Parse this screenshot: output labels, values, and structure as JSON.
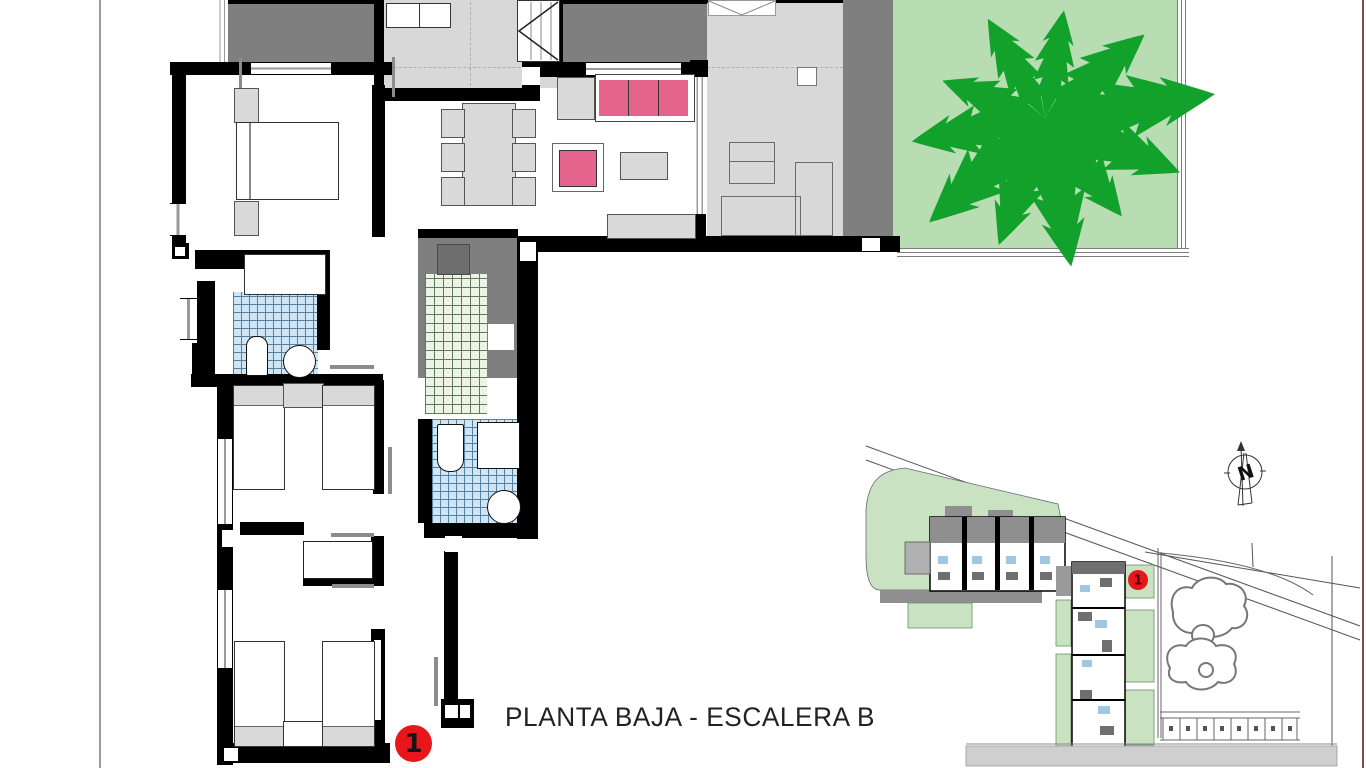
{
  "page": {
    "background": "#ffffff",
    "fold_line_color": "#9b9b9b",
    "edge_line_color": "#8a4a44"
  },
  "plan": {
    "title": "PLANTA BAJA - ESCALERA B",
    "unit_marker": "1",
    "colors": {
      "wall": "#000000",
      "dark_floor": "#7f7f7f",
      "light_floor": "#d8d8d8",
      "furniture_gray": "#d9d9d9",
      "sofa_pink": "#e4648e",
      "garden_green": "#b9ddb3",
      "tree_green": "#12a12b",
      "bath_tile_blue": "#cfe5f3",
      "patio_tile_green": "#edf4e6",
      "marker_red": "#e8151b"
    }
  },
  "siteplan": {
    "unit_marker": "1",
    "north_label": "N",
    "green": "#c9e2c2",
    "road_gray": "#cfcfcf"
  }
}
